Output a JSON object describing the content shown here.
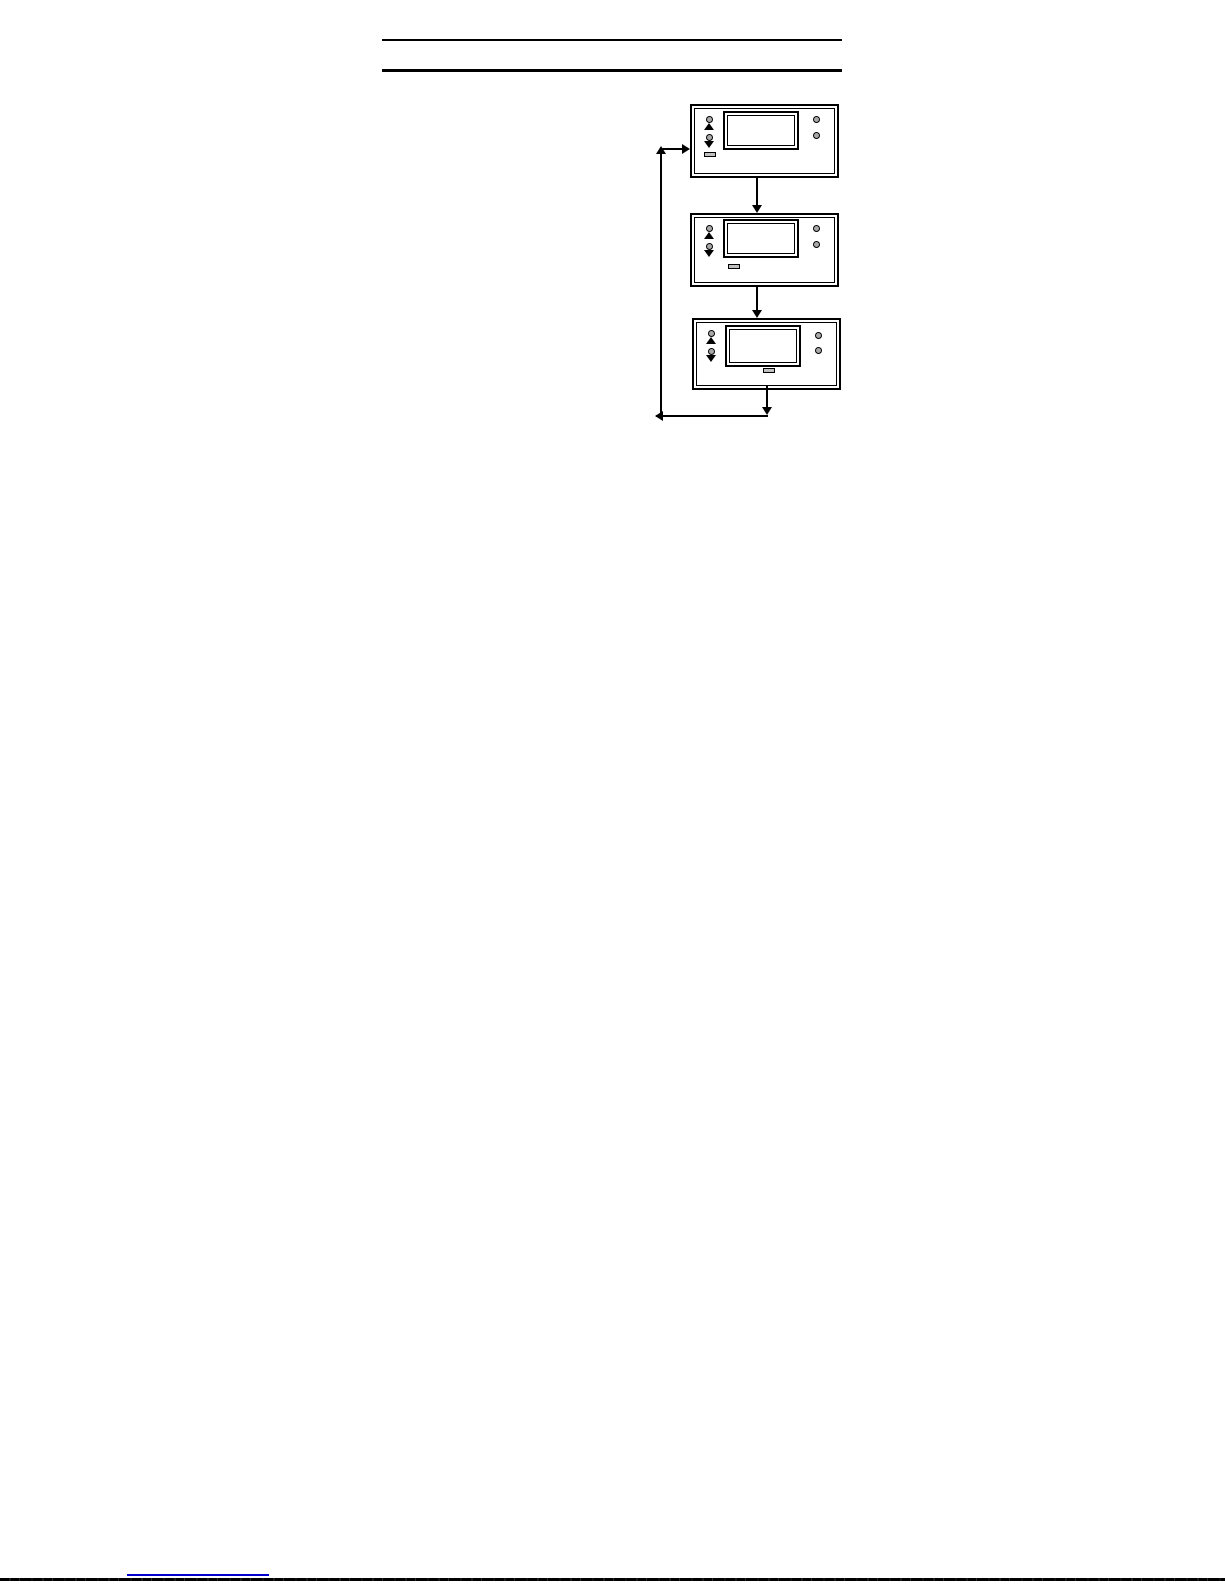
{
  "document": {
    "background": "#ffffff",
    "page_width": 1225,
    "page_height": 1585
  },
  "colors": {
    "line": "#000000",
    "led_fill": "#a9a9a9",
    "button_fill": "#c0c0c0",
    "lcd_fill": "#ffffff",
    "link_underline": "#0000cc"
  },
  "header": {
    "rule_count": 2
  },
  "diagram": {
    "type": "flow",
    "panels": [
      {
        "name": "panel-step-1",
        "display_text": "",
        "left_icons": [
          "led",
          "up-arrow",
          "led",
          "down-arrow",
          "button"
        ],
        "right_icons": [
          "led",
          "led"
        ]
      },
      {
        "name": "panel-step-2",
        "display_text": "",
        "left_icons": [
          "led",
          "up-arrow",
          "led",
          "down-arrow"
        ],
        "below_display_icons": [
          "button"
        ],
        "right_icons": [
          "led",
          "led"
        ]
      },
      {
        "name": "panel-step-3",
        "display_text": "",
        "left_icons": [
          "led",
          "up-arrow",
          "led",
          "down-arrow"
        ],
        "below_display_icons": [
          "button"
        ],
        "right_icons": [
          "led",
          "led"
        ]
      }
    ],
    "flow": [
      "panel-step-1 -> panel-step-2",
      "panel-step-2 -> panel-step-3",
      "panel-step-3 -> panel-step-1"
    ]
  },
  "footer": {
    "link_text": ""
  }
}
